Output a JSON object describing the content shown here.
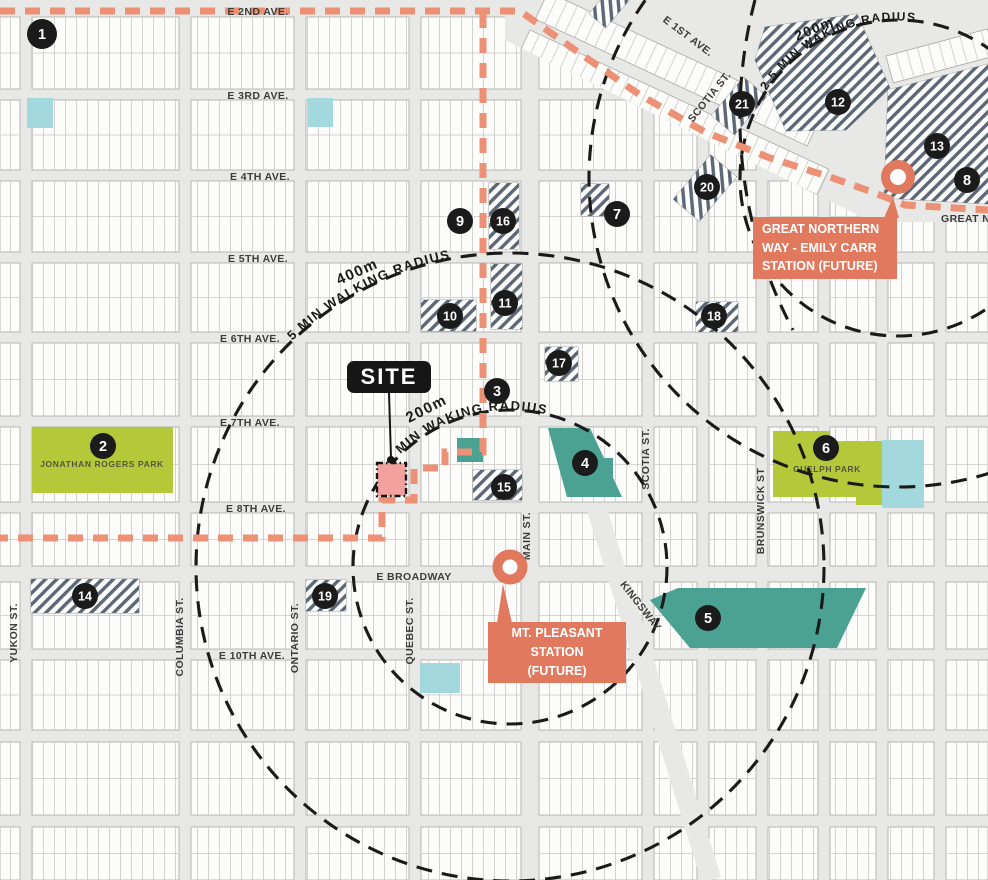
{
  "map": {
    "colors": {
      "background": "#e8e8e6",
      "block_fill": "#fcfcfb",
      "block_stroke": "#a8a7a4",
      "parcel_line": "#c9c8c5",
      "hatch_stripe": "#5d6876",
      "dashed_circle": "#1a1a1a",
      "route_salmon": "#ec9175",
      "station_accent": "#e0795e",
      "site_pink": "#f3a19e",
      "park_green": "#b4c93a",
      "teal_area": "#4ba192",
      "cyan_area": "#a3d8dd",
      "street_label": "#3c3c3c"
    },
    "site": {
      "label": "SITE",
      "radius_note": "2.5"
    },
    "stations": [
      {
        "id": "mt-pleasant",
        "name_lines": [
          "MT. PLEASANT",
          "STATION",
          "(FUTURE)"
        ]
      },
      {
        "id": "great-northern-way",
        "name_lines": [
          "GREAT NORTHERN",
          "WAY - EMILY CARR",
          "STATION (FUTURE)"
        ]
      }
    ],
    "parks": [
      {
        "name": "JONATHAN ROGERS PARK",
        "badge": "2"
      },
      {
        "name": "GUELPH PARK",
        "badge": "6"
      }
    ],
    "walking_radii": [
      {
        "distance": "400m",
        "label": "5 MIN WALKING RADIUS",
        "center": "mt-pleasant"
      },
      {
        "distance": "200m",
        "label": "2.5 MIN WAKING RADIUS",
        "center": "mt-pleasant"
      },
      {
        "distance": "200m",
        "label": "2.5 MIN WAKING RADIUS",
        "center": "great-northern-way"
      }
    ],
    "landmarks": [
      {
        "n": "1",
        "x": 42,
        "y": 34
      },
      {
        "n": "2",
        "x": 103,
        "y": 446
      },
      {
        "n": "3",
        "x": 497,
        "y": 391
      },
      {
        "n": "4",
        "x": 585,
        "y": 463
      },
      {
        "n": "5",
        "x": 708,
        "y": 618
      },
      {
        "n": "6",
        "x": 826,
        "y": 448
      },
      {
        "n": "7",
        "x": 617,
        "y": 214
      },
      {
        "n": "8",
        "x": 967,
        "y": 180
      },
      {
        "n": "9",
        "x": 460,
        "y": 221
      },
      {
        "n": "10",
        "x": 450,
        "y": 316
      },
      {
        "n": "11",
        "x": 505,
        "y": 303
      },
      {
        "n": "12",
        "x": 838,
        "y": 102
      },
      {
        "n": "13",
        "x": 937,
        "y": 146
      },
      {
        "n": "14",
        "x": 85,
        "y": 596
      },
      {
        "n": "15",
        "x": 504,
        "y": 487
      },
      {
        "n": "16",
        "x": 503,
        "y": 221
      },
      {
        "n": "17",
        "x": 559,
        "y": 363
      },
      {
        "n": "18",
        "x": 714,
        "y": 316
      },
      {
        "n": "19",
        "x": 325,
        "y": 596
      },
      {
        "n": "20",
        "x": 707,
        "y": 187
      },
      {
        "n": "21",
        "x": 742,
        "y": 104
      }
    ],
    "streets": {
      "avenues": [
        {
          "t": "E 2ND AVE.",
          "x": 258,
          "y": 15
        },
        {
          "t": "E 3RD AVE.",
          "x": 258,
          "y": 99
        },
        {
          "t": "E 4TH AVE.",
          "x": 260,
          "y": 180
        },
        {
          "t": "E 5TH AVE.",
          "x": 258,
          "y": 262
        },
        {
          "t": "E 6TH AVE.",
          "x": 250,
          "y": 342
        },
        {
          "t": "E 7TH AVE.",
          "x": 250,
          "y": 426
        },
        {
          "t": "E 8TH AVE.",
          "x": 256,
          "y": 512
        },
        {
          "t": "E BROADWAY",
          "x": 414,
          "y": 580,
          "size": 12
        },
        {
          "t": "E 10TH AVE.",
          "x": 252,
          "y": 659
        }
      ],
      "verticals": [
        {
          "t": "YUKON ST.",
          "x": 17,
          "y": 633
        },
        {
          "t": "COLUMBIA ST.",
          "x": 183,
          "y": 637
        },
        {
          "t": "ONTARIO ST.",
          "x": 298,
          "y": 638
        },
        {
          "t": "QUEBEC ST.",
          "x": 413,
          "y": 631
        },
        {
          "t": "MAIN ST.",
          "x": 530,
          "y": 536
        },
        {
          "t": "SCOTIA ST.",
          "x": 649,
          "y": 459
        },
        {
          "t": "BRUNSWICK ST",
          "x": 764,
          "y": 511
        }
      ],
      "diagonals": [
        {
          "t": "E 1ST AVE.",
          "x": 686,
          "y": 39,
          "a": 37
        },
        {
          "t": "SCOTIA ST.",
          "x": 712,
          "y": 99,
          "a": -51
        },
        {
          "t": "KINGSWAY",
          "x": 638,
          "y": 608,
          "a": 52
        },
        {
          "t": "GREAT NORTHERN WAY",
          "x": 941,
          "y": 222,
          "a": 0,
          "anchor": "start"
        }
      ]
    },
    "geometry": {
      "colSpans": [
        [
          0,
          20
        ],
        [
          32,
          179
        ],
        [
          191,
          294
        ],
        [
          306,
          409
        ],
        [
          421,
          521
        ],
        [
          539,
          642
        ],
        [
          654,
          697
        ],
        [
          709,
          756
        ],
        [
          768,
          818
        ],
        [
          830,
          876
        ],
        [
          888,
          934
        ],
        [
          946,
          988
        ]
      ],
      "rowSpans": [
        [
          17,
          89
        ],
        [
          100,
          170
        ],
        [
          181,
          252
        ],
        [
          263,
          332
        ],
        [
          343,
          416
        ],
        [
          427,
          502
        ],
        [
          513,
          566
        ],
        [
          582,
          649
        ],
        [
          660,
          730
        ],
        [
          742,
          815
        ],
        [
          827,
          880
        ]
      ],
      "zone": "505,0 988,0 988,222 872,222 505,40",
      "strips": [
        {
          "t": [
            548,
            -8
          ],
          "a": 25,
          "w": 300,
          "h": 30
        },
        {
          "t": [
            530,
            30
          ],
          "a": 25,
          "w": 330,
          "h": 28
        },
        {
          "t": [
            515,
            64
          ],
          "a": 25,
          "w": 360,
          "h": 30
        },
        {
          "t": [
            886,
            56
          ],
          "a": -15,
          "w": 105,
          "h": 28
        }
      ],
      "kingsway": "586,508 702,883 721,877 605,502",
      "hatch_rects": [
        [
          489,
          183,
          30,
          66
        ],
        [
          491,
          264,
          31,
          65
        ],
        [
          421,
          300,
          55,
          31
        ],
        [
          545,
          347,
          33,
          34
        ],
        [
          696,
          302,
          42,
          30
        ],
        [
          581,
          184,
          28,
          32
        ],
        [
          473,
          470,
          49,
          30
        ],
        [
          31,
          579,
          108,
          34
        ],
        [
          306,
          580,
          40,
          31
        ]
      ],
      "hatch_rot": [
        [
          705,
          188,
          58,
          34,
          -50
        ],
        [
          739,
          106,
          50,
          30,
          -50
        ],
        [
          609,
          7,
          36,
          22,
          -50
        ]
      ],
      "hatch_polys": [
        "765,27 857,14 890,88 846,130 786,131 755,60",
        "888,90 988,64 988,204 884,198"
      ],
      "teal_polys": [
        "548,428 590,428 622,497 567,497",
        "650,600 678,588 866,588 837,648 690,648",
        "968,118 988,118 988,203 968,203",
        "599,458 613,458 613,495 599,495",
        "457,438 483,438 483,462 457,462"
      ],
      "cyan_rects": [
        [
          27,
          98,
          26,
          30
        ],
        [
          308,
          98,
          25,
          29
        ],
        [
          882,
          440,
          42,
          68
        ],
        [
          420,
          663,
          40,
          30
        ]
      ],
      "circles": [
        [
          510,
          567,
          157
        ],
        [
          510,
          567,
          314
        ],
        [
          898,
          178,
          158
        ],
        [
          898,
          178,
          309
        ]
      ],
      "arc_extra": "M755,0 A456,456 0 0 0 793,330",
      "routes": [
        "M0,11 L520,11 L575,50 L640,95 L705,132 L770,158 L830,177 L875,193 L905,205 L988,210",
        "M483,13 L483,452 L445,452 L445,468 L414,468 L414,500 L382,500 L382,538 L0,538"
      ],
      "park_polys": [
        "32,427 173,427 173,493 32,493",
        "773,431 830,431 830,441 882,441 882,505 856,505 856,497 773,497"
      ],
      "park_labels": [
        [
          102,
          467
        ],
        [
          827,
          472
        ]
      ],
      "site_square": [
        377,
        463,
        29,
        33
      ],
      "leader": [
        389,
        393,
        391,
        458
      ],
      "stations_geo": [
        {
          "x": 510,
          "y": 567,
          "r": 12.5,
          "sw": 10,
          "ptr": "497,623 512,623 503,584"
        },
        {
          "x": 898,
          "y": 177,
          "r": 12.5,
          "sw": 9,
          "ptr": "884,218 899,218 893,197"
        }
      ],
      "arc_labels": [
        {
          "path": "M288,345 A314,314 0 0 1 499,253",
          "text": "5 MIN WALKING RADIUS",
          "off": 6,
          "size": 13
        },
        {
          "path": "M381,477 A157,157 0 0 1 588,431",
          "text": "MIN WAKING RADIUS",
          "off": 30,
          "size": 13
        },
        {
          "path": "M764,94 A158,158 0 0 1 920,22",
          "text": "2.5 MIN WAKING RADIUS",
          "off": 4,
          "size": 12
        }
      ],
      "rot_labels": [
        {
          "text": "400m",
          "x": 339,
          "y": 285,
          "a": -24,
          "size": 15
        },
        {
          "text": "200m",
          "x": 409,
          "y": 423,
          "a": -27,
          "size": 15
        },
        {
          "text": "200m",
          "x": 797,
          "y": 41,
          "a": -23,
          "size": 14
        },
        {
          "text": "2.5",
          "x": 396,
          "y": 487,
          "a": -65,
          "size": 12.5,
          "color": "#8a3a33"
        }
      ]
    }
  }
}
